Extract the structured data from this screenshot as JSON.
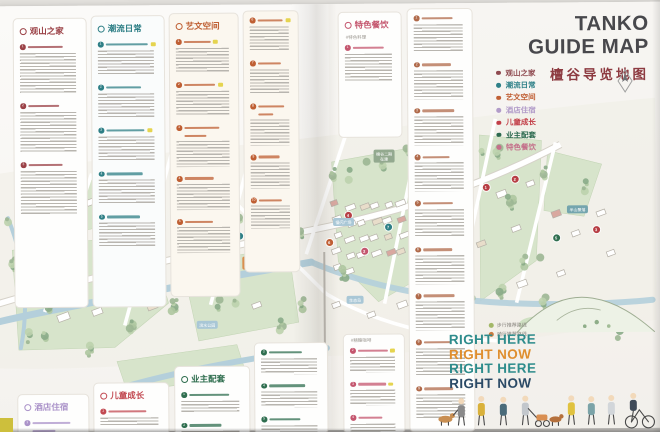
{
  "title_block": {
    "line1": "TANKO",
    "line2": "GUIDE MAP",
    "subtitle": "檀谷导览地图",
    "title_color": "#48484c",
    "subtitle_color": "#8d3b41"
  },
  "legend": {
    "items": [
      {
        "label": "观山之家",
        "color": "#8f4a50"
      },
      {
        "label": "潮流日常",
        "color": "#2e8088"
      },
      {
        "label": "艺文空间",
        "color": "#c05f35"
      },
      {
        "label": "酒店住宿",
        "color": "#b29cc9"
      },
      {
        "label": "儿童成长",
        "color": "#c23f48"
      },
      {
        "label": "业主配套",
        "color": "#2c6a4f"
      },
      {
        "label": "特色餐饮",
        "color": "#c4708a"
      }
    ]
  },
  "panels": {
    "guanshan": {
      "header": "观山之家",
      "color": "#9b4247",
      "items": [
        {
          "n": "1",
          "lines": 13,
          "w": 58
        },
        {
          "n": "2",
          "lines": 13,
          "w": 52
        },
        {
          "n": "3",
          "lines": 14,
          "w": 56
        }
      ]
    },
    "trend": {
      "header": "潮流日常",
      "color": "#2e7f86",
      "items": [
        {
          "n": "1",
          "lines": 8,
          "w": 70,
          "tag": true
        },
        {
          "n": "2",
          "lines": 8,
          "w": 58
        },
        {
          "n": "3",
          "lines": 8,
          "w": 64,
          "tag": true
        },
        {
          "n": "4",
          "lines": 8,
          "w": 60
        },
        {
          "n": "5",
          "lines": 8,
          "w": 55
        }
      ]
    },
    "art": {
      "header": "艺文空间",
      "color": "#bf5f33",
      "items": [
        {
          "n": "1",
          "lines": 8,
          "w": 48,
          "tag": true
        },
        {
          "n": "2",
          "lines": 8,
          "w": 56,
          "tag": true
        },
        {
          "n": "3",
          "lines": 8,
          "w": 62,
          "t2": true
        },
        {
          "n": "4",
          "lines": 8,
          "w": 52
        },
        {
          "n": "5",
          "lines": 8,
          "w": 50
        }
      ]
    },
    "art_cont": {
      "header": "",
      "color": "#bf5f33",
      "items": [
        {
          "n": "6",
          "lines": 8,
          "w": 60,
          "tag": true
        },
        {
          "n": "7",
          "lines": 8,
          "w": 55
        },
        {
          "n": "8",
          "lines": 8,
          "w": 62,
          "t2": true
        },
        {
          "n": "9",
          "lines": 8,
          "w": 50
        },
        {
          "n": "10",
          "lines": 7,
          "w": 55
        }
      ]
    },
    "food": {
      "header": "特色餐饮",
      "color": "#c4566e",
      "sub": "#特色料理",
      "items": [
        {
          "n": "1",
          "lines": 9,
          "w": 62
        }
      ]
    },
    "right_col": {
      "header": "",
      "color": "#b06a4a",
      "items": [
        {
          "n": "1",
          "lines": 9,
          "w": 60
        },
        {
          "n": "2",
          "lines": 9,
          "w": 55
        },
        {
          "n": "3",
          "lines": 9,
          "w": 62
        },
        {
          "n": "4",
          "lines": 9,
          "w": 52
        },
        {
          "n": "5",
          "lines": 9,
          "w": 58
        },
        {
          "n": "6",
          "lines": 9,
          "w": 55
        },
        {
          "n": "7",
          "lines": 9,
          "w": 60
        },
        {
          "n": "8",
          "lines": 9,
          "w": 52
        },
        {
          "n": "9",
          "lines": 8,
          "w": 56
        }
      ]
    },
    "hotel": {
      "header": "酒店住宿",
      "color": "#ab93c9",
      "items": [
        {
          "n": "1",
          "lines": 3,
          "w": 66,
          "t2": true
        }
      ]
    },
    "kids": {
      "header": "儿童成长",
      "color": "#c24a52",
      "items": [
        {
          "n": "1",
          "lines": 3,
          "w": 62
        },
        {
          "n": "2",
          "lines": 2,
          "w": 58
        }
      ]
    },
    "owner": {
      "header": "业主配套",
      "color": "#2f6e4f",
      "items": [
        {
          "n": "1",
          "lines": 4,
          "w": 64
        },
        {
          "n": "2",
          "lines": 4,
          "w": 52
        }
      ]
    },
    "owner_cont": {
      "header": "",
      "color": "#2f6e4f",
      "items": [
        {
          "n": "3",
          "lines": 5,
          "w": 55
        },
        {
          "n": "4",
          "lines": 5,
          "w": 60
        },
        {
          "n": "5",
          "lines": 4,
          "w": 52
        }
      ]
    },
    "food_cont": {
      "header": "",
      "color": "#c4566e",
      "sub": "#精酿咖啡",
      "items": [
        {
          "n": "2",
          "lines": 5,
          "w": 62,
          "tag": true
        },
        {
          "n": "3",
          "lines": 5,
          "w": 58,
          "tag": true
        },
        {
          "n": "4",
          "lines": 4,
          "w": 50
        }
      ]
    }
  },
  "map": {
    "badges": [
      {
        "text": "檀谷二期|在建",
        "bg": "#93a98f",
        "x": 378,
        "y": 146
      },
      {
        "text": "檀谷慢闪|先行站",
        "bg": "#d98f4e",
        "x": 246,
        "y": 252
      },
      {
        "text": "半山聚落",
        "bg": "#74a5ae",
        "x": 571,
        "y": 203
      },
      {
        "text": "慢闪广场",
        "bg": "#a9c7d6",
        "x": 337,
        "y": 214
      },
      {
        "text": "大草坪",
        "bg": "#a9c7d6",
        "x": 60,
        "y": 285
      },
      {
        "text": "滨水公园",
        "bg": "#a9c7d6",
        "x": 200,
        "y": 316
      },
      {
        "text": "生态岛",
        "bg": "#a9c7d6",
        "x": 350,
        "y": 292
      }
    ],
    "pins": [
      {
        "n": "1",
        "x": 490,
        "y": 184,
        "c": "#b73e44"
      },
      {
        "n": "2",
        "x": 519,
        "y": 176,
        "c": "#b73e44"
      },
      {
        "n": "3",
        "x": 436,
        "y": 196,
        "c": "#b73e44"
      },
      {
        "n": "4",
        "x": 352,
        "y": 211,
        "c": "#b73e44"
      },
      {
        "n": "5",
        "x": 222,
        "y": 243,
        "c": "#b73e44"
      },
      {
        "n": "6",
        "x": 243,
        "y": 231,
        "c": "#2e7f86"
      },
      {
        "n": "7",
        "x": 392,
        "y": 223,
        "c": "#2e7f86"
      },
      {
        "n": "8",
        "x": 470,
        "y": 259,
        "c": "#b73e44"
      },
      {
        "n": "9",
        "x": 430,
        "y": 269,
        "c": "#2f6e4f"
      },
      {
        "n": "2",
        "x": 368,
        "y": 247,
        "c": "#c4566e"
      },
      {
        "n": "5",
        "x": 560,
        "y": 235,
        "c": "#2f6e4f"
      },
      {
        "n": "3",
        "x": 600,
        "y": 227,
        "c": "#b73e44"
      },
      {
        "n": "1",
        "x": 152,
        "y": 236,
        "c": "#c05f35"
      },
      {
        "n": "4",
        "x": 30,
        "y": 193,
        "c": "#b73e44"
      },
      {
        "n": "6",
        "x": 333,
        "y": 238,
        "c": "#c05f35"
      }
    ],
    "route_legend": [
      {
        "label": "步行推荐路线",
        "color": "#a3b868"
      },
      {
        "label": "骑行推荐路线",
        "color": "#cb7a3e"
      }
    ]
  },
  "right_here": {
    "lines": [
      {
        "text": "RIGHT HERE",
        "color": "#2e8c8c"
      },
      {
        "text": "RIGHT NOW",
        "color": "#df8e2e"
      },
      {
        "text": "RIGHT HERE",
        "color": "#2e8c8c"
      },
      {
        "text": "RIGHT NOW",
        "color": "#2b4a66"
      }
    ]
  }
}
